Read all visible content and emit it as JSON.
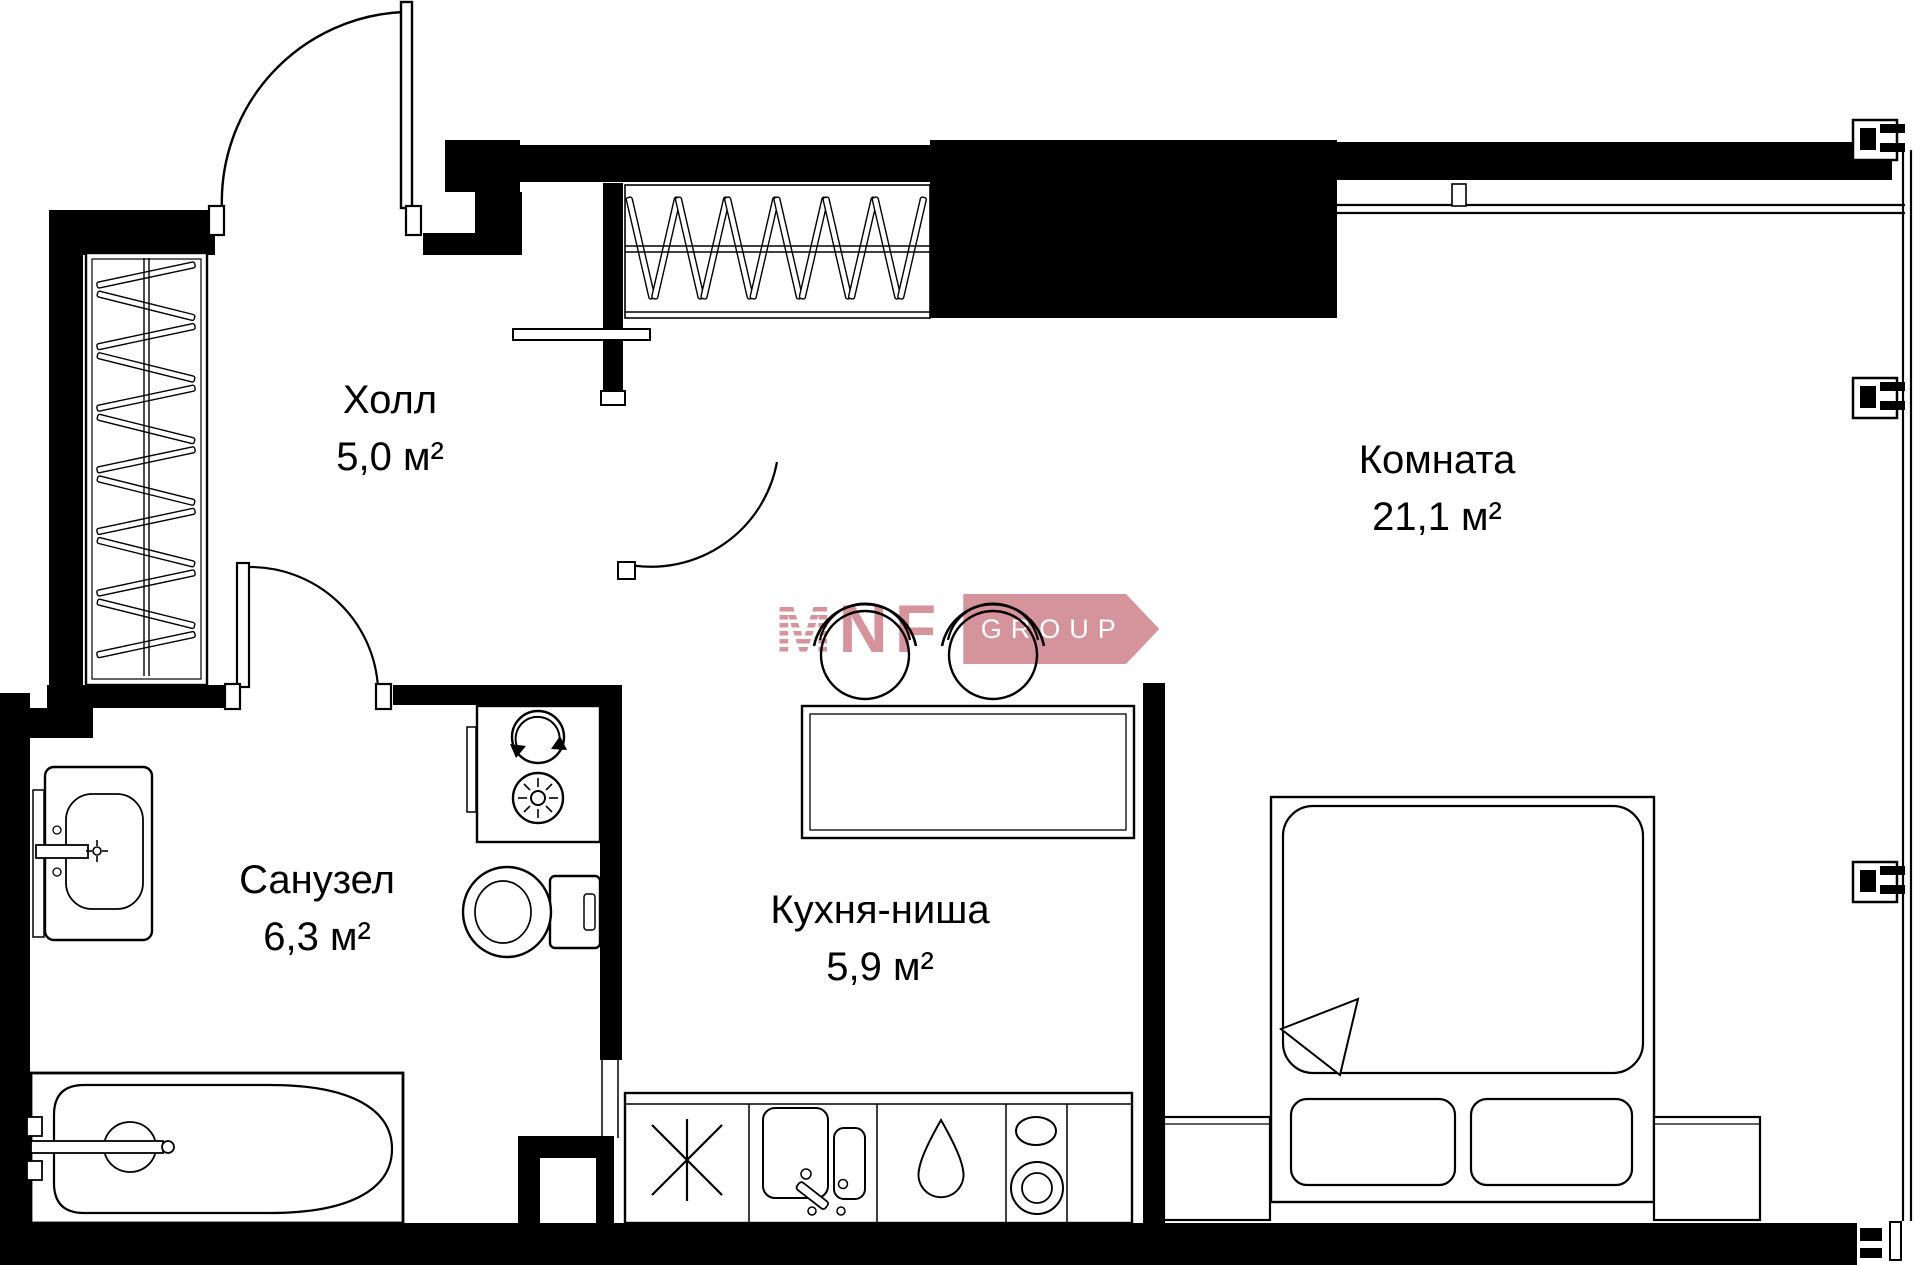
{
  "rooms": [
    {
      "name": "Холл",
      "area": "5,0 м²"
    },
    {
      "name": "Комната",
      "area": "21,1 м²"
    },
    {
      "name": "Санузел",
      "area": "6,3 м²"
    },
    {
      "name": "Кухня-ниша",
      "area": "5,9 м²"
    }
  ],
  "logo": {
    "m": "M",
    "nf": "NF",
    "group": "GROUP"
  },
  "colors": {
    "wall": "#000000",
    "background": "#ffffff",
    "logo_pink": "#d5939b",
    "logo_group_text": "#ffffff"
  },
  "fixtures": [
    "entrance-door",
    "hall-wardrobe",
    "hall-closet",
    "washer-dryer-stack",
    "toilet",
    "washbasin",
    "bathtub",
    "kitchen-counter",
    "fridge-snowflake",
    "kitchen-sink",
    "water-drop",
    "hob-burners",
    "dining-table",
    "bar-stools",
    "bed",
    "pillows",
    "nightstands",
    "window-band",
    "window-wall"
  ]
}
